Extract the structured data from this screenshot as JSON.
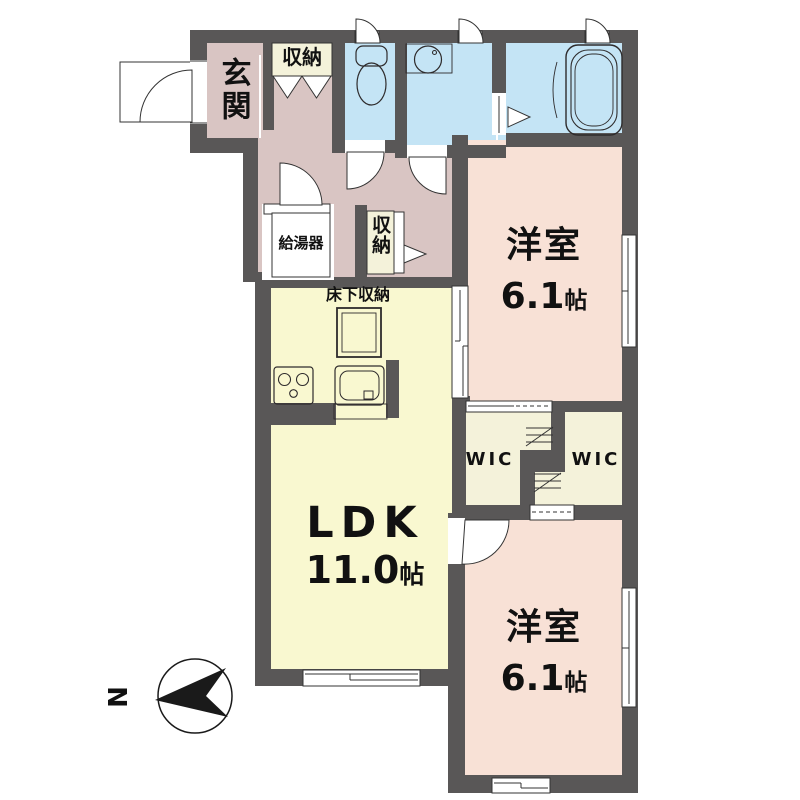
{
  "plan": {
    "rooms": {
      "genkan": {
        "label": "玄関"
      },
      "closet_top": {
        "label": "収納"
      },
      "closet_hall": {
        "label": "収納"
      },
      "water_heater": {
        "label": "給湯器"
      },
      "underfloor_storage": {
        "label": "床下収納"
      },
      "ldk": {
        "name": "LDK",
        "area": "11.0",
        "unit": "帖"
      },
      "bedroom_top": {
        "name": "洋室",
        "area": "6.1",
        "unit": "帖"
      },
      "bedroom_bottom": {
        "name": "洋室",
        "area": "6.1",
        "unit": "帖"
      },
      "wic_left": {
        "label": "WIC"
      },
      "wic_right": {
        "label": "WIC"
      }
    },
    "compass": {
      "north_label": "N"
    },
    "colors": {
      "wall": "#595757",
      "hall": "#d9c5c3",
      "wet": "#c4e4f5",
      "bedroom": "#f8e1d6",
      "ldk": "#f9f8d0",
      "closet": "#f4f2da",
      "line": "#333333",
      "text": "#111111",
      "bg": "#ffffff"
    }
  }
}
